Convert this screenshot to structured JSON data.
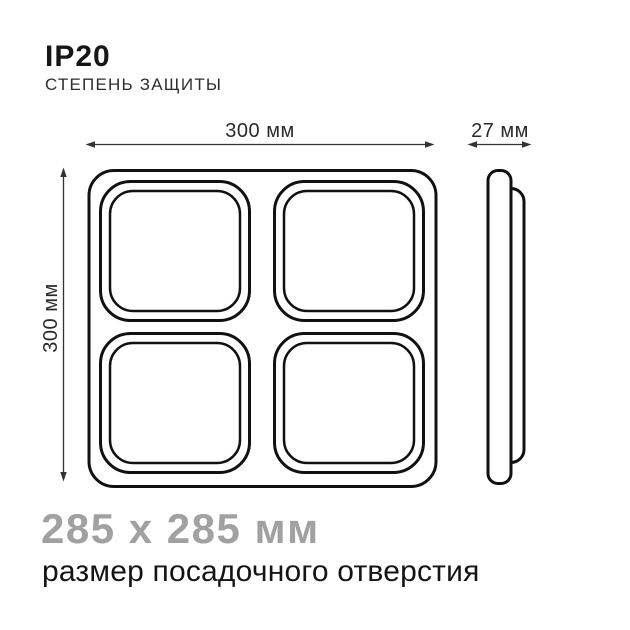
{
  "colors": {
    "ink": "#161616",
    "line": "#111111",
    "dimension": "#333333",
    "muted_gray": "#a1a1a1",
    "background": "#ffffff"
  },
  "header": {
    "rating": "IP20",
    "caption": "СТЕПЕНЬ ЗАЩИТЫ"
  },
  "front_view": {
    "width_label": "300 мм",
    "height_label": "300 мм"
  },
  "side_view": {
    "depth_label": "27 мм"
  },
  "footer": {
    "cutout_size": "285 x 285 мм",
    "cutout_caption": "размер посадочного отверстия"
  }
}
